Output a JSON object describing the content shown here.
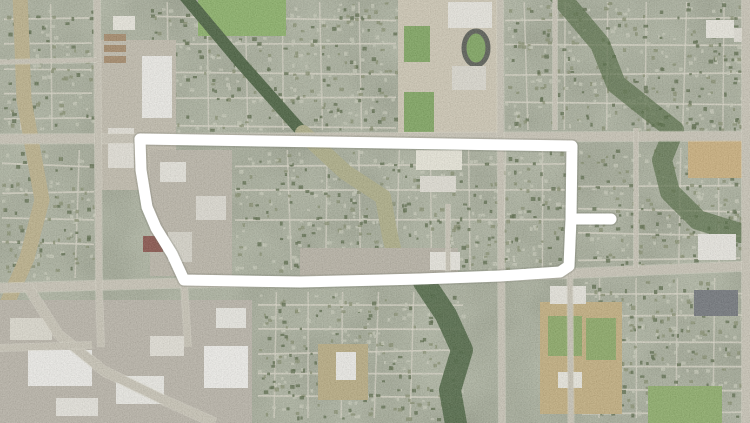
{
  "map": {
    "scene": "aerial-satellite-suburban-grid-with-route-overlay",
    "width": 750,
    "height": 423,
    "seed": 1337,
    "palette": {
      "residential_base": "#96a081",
      "street_minor": "#d7d3c2",
      "road_major": "#c6c1b0",
      "road_edge": "#dcd8c9",
      "roof_light": "#c3c7b1",
      "tree_dark": "#42552e",
      "shrub_olive": "#75805a",
      "route_white": "#ffffff",
      "route_shadow": "#6f7468"
    },
    "route": {
      "color": "#ffffff",
      "stroke_width": 11,
      "loop": [
        [
          572,
          146
        ],
        [
          140,
          139
        ],
        [
          141,
          170
        ],
        [
          147,
          207
        ],
        [
          156,
          228
        ],
        [
          172,
          254
        ],
        [
          184,
          280
        ],
        [
          300,
          282
        ],
        [
          420,
          279
        ],
        [
          500,
          276
        ],
        [
          560,
          272
        ],
        [
          569,
          266
        ],
        [
          571,
          219
        ],
        [
          572,
          146
        ]
      ],
      "spur": [
        [
          572,
          219
        ],
        [
          611,
          219
        ]
      ]
    },
    "roads_major": [
      {
        "name": "arterial-top",
        "width": 9,
        "points": [
          [
            0,
            139
          ],
          [
            750,
            136
          ]
        ]
      },
      {
        "name": "arterial-bottom",
        "width": 9,
        "points": [
          [
            0,
            288
          ],
          [
            184,
            283
          ],
          [
            390,
            280
          ],
          [
            508,
            276
          ],
          [
            750,
            266
          ]
        ]
      },
      {
        "name": "arterial-left-vertical",
        "width": 6,
        "points": [
          [
            97,
            0
          ],
          [
            99,
            290
          ],
          [
            101,
            347
          ]
        ]
      },
      {
        "name": "arterial-center-vertical",
        "width": 6,
        "points": [
          [
            500,
            0
          ],
          [
            502,
            423
          ]
        ]
      },
      {
        "name": "street-route-east-vertical",
        "width": 5,
        "points": [
          [
            569,
            140
          ],
          [
            571,
            423
          ]
        ]
      },
      {
        "name": "arterial-right-vertical",
        "width": 8,
        "points": [
          [
            746,
            0
          ],
          [
            746,
            423
          ]
        ]
      },
      {
        "name": "street-east-mid-vertical",
        "width": 4,
        "points": [
          [
            636,
            128
          ],
          [
            636,
            268
          ]
        ]
      },
      {
        "name": "street-center-mid-vertical",
        "width": 4,
        "points": [
          [
            448,
            204
          ],
          [
            448,
            281
          ]
        ]
      },
      {
        "name": "street-ne-vertical",
        "width": 4,
        "points": [
          [
            555,
            0
          ],
          [
            555,
            130
          ]
        ]
      },
      {
        "name": "arterial-sw-diagonal",
        "width": 9,
        "points": [
          [
            28,
            287
          ],
          [
            58,
            334
          ],
          [
            104,
            371
          ],
          [
            166,
            401
          ],
          [
            215,
            423
          ]
        ]
      },
      {
        "name": "street-sw-horizontal",
        "width": 6,
        "points": [
          [
            0,
            348
          ],
          [
            92,
            345
          ]
        ]
      },
      {
        "name": "street-route-west-diagonal",
        "width": 6,
        "points": [
          [
            140,
            139
          ],
          [
            143,
            192
          ],
          [
            152,
            220
          ],
          [
            171,
            253
          ],
          [
            184,
            283
          ],
          [
            188,
            347
          ]
        ]
      },
      {
        "name": "street-route-spur",
        "width": 4,
        "points": [
          [
            570,
            219
          ],
          [
            616,
            219
          ]
        ]
      },
      {
        "name": "street-nw-horizontal",
        "width": 4,
        "points": [
          [
            0,
            62
          ],
          [
            97,
            60
          ]
        ]
      }
    ],
    "districts": [
      {
        "name": "nw-residential",
        "x": 4,
        "y": 4,
        "w": 88,
        "h": 126,
        "hs": 25,
        "vs": 32
      },
      {
        "name": "north-central-residential",
        "x": 150,
        "y": 2,
        "w": 246,
        "h": 128,
        "hs": 27,
        "vs": 38
      },
      {
        "name": "ne-residential",
        "x": 505,
        "y": 2,
        "w": 238,
        "h": 128,
        "hs": 28,
        "vs": 40
      },
      {
        "name": "east-residential",
        "x": 578,
        "y": 148,
        "w": 162,
        "h": 116,
        "hs": 24,
        "vs": 40
      },
      {
        "name": "inner-loop-residential",
        "x": 235,
        "y": 150,
        "w": 330,
        "h": 120,
        "hs": 26,
        "vs": 36
      },
      {
        "name": "west-mid-residential",
        "x": 2,
        "y": 150,
        "w": 92,
        "h": 128,
        "hs": 26,
        "vs": 30
      },
      {
        "name": "se-residential",
        "x": 582,
        "y": 278,
        "w": 160,
        "h": 140,
        "hs": 24,
        "vs": 38
      },
      {
        "name": "south-central-residential",
        "x": 258,
        "y": 292,
        "w": 205,
        "h": 126,
        "hs": 23,
        "vs": 34
      }
    ],
    "features": [
      {
        "name": "creek-west",
        "kind": "path",
        "stroke": "#b7aa7c",
        "width": 15,
        "points": [
          [
            20,
            -6
          ],
          [
            24,
            100
          ],
          [
            42,
            200
          ],
          [
            27,
            258
          ],
          [
            5,
            308
          ]
        ]
      },
      {
        "name": "park-north",
        "kind": "rect",
        "x": 198,
        "y": 0,
        "w": 88,
        "h": 36,
        "fill": "#7caa52"
      },
      {
        "name": "tree-corridor-nw",
        "kind": "path",
        "stroke": "#2e4a22",
        "width": 12,
        "points": [
          [
            183,
            -6
          ],
          [
            240,
            62
          ],
          [
            303,
            133
          ]
        ]
      },
      {
        "name": "greenway-central",
        "kind": "path",
        "stroke": "#a6a678",
        "width": 16,
        "points": [
          [
            303,
            133
          ],
          [
            345,
            172
          ],
          [
            383,
            197
          ],
          [
            390,
            236
          ],
          [
            399,
            272
          ]
        ]
      },
      {
        "name": "creek-south",
        "kind": "path",
        "stroke": "#2f4d22",
        "width": 22,
        "opacity": 0.9,
        "points": [
          [
            424,
            282
          ],
          [
            446,
            315
          ],
          [
            462,
            350
          ],
          [
            450,
            390
          ],
          [
            456,
            424
          ]
        ]
      },
      {
        "name": "ne-forest-corridor",
        "kind": "path",
        "stroke": "#33511f",
        "width": 20,
        "opacity": 0.7,
        "points": [
          [
            558,
            -6
          ],
          [
            578,
            18
          ],
          [
            600,
            44
          ],
          [
            616,
            84
          ],
          [
            646,
            108
          ],
          [
            674,
            130
          ],
          [
            662,
            160
          ],
          [
            670,
            192
          ],
          [
            698,
            220
          ],
          [
            740,
            233
          ]
        ]
      },
      {
        "name": "school-campus",
        "kind": "rect",
        "x": 398,
        "y": 0,
        "w": 102,
        "h": 138,
        "fill": "#cdc5ae"
      },
      {
        "name": "school-field-a",
        "kind": "rect",
        "x": 404,
        "y": 92,
        "w": 30,
        "h": 40,
        "fill": "#6e9c49"
      },
      {
        "name": "school-field-b",
        "kind": "rect",
        "x": 404,
        "y": 26,
        "w": 26,
        "h": 36,
        "fill": "#6e9c49"
      },
      {
        "name": "track-oval",
        "kind": "ellipse",
        "cx": 476,
        "cy": 48,
        "rx": 12,
        "ry": 17,
        "fill": "#6e9c49",
        "stroke": "#41453c",
        "sw": 5
      },
      {
        "name": "school-building-a",
        "kind": "rect",
        "x": 448,
        "y": 2,
        "w": 44,
        "h": 26,
        "fill": "#ebe9e0"
      },
      {
        "name": "school-building-b",
        "kind": "rect",
        "x": 452,
        "y": 66,
        "w": 34,
        "h": 24,
        "fill": "#dcd9cd"
      },
      {
        "name": "west-retail-lot",
        "kind": "rect",
        "x": 98,
        "y": 40,
        "w": 78,
        "h": 150,
        "fill": "#bdb7a5"
      },
      {
        "name": "west-retail-building-a",
        "kind": "rect",
        "x": 142,
        "y": 56,
        "w": 30,
        "h": 62,
        "fill": "#f1f0ea"
      },
      {
        "name": "west-retail-building-b",
        "kind": "rect",
        "x": 108,
        "y": 128,
        "w": 26,
        "h": 40,
        "fill": "#e5e2d7"
      },
      {
        "name": "storage-row-a",
        "kind": "rect",
        "x": 104,
        "y": 34,
        "w": 22,
        "h": 7,
        "fill": "#9b7b55"
      },
      {
        "name": "storage-row-b",
        "kind": "rect",
        "x": 104,
        "y": 45,
        "w": 22,
        "h": 7,
        "fill": "#9b7b55"
      },
      {
        "name": "storage-row-c",
        "kind": "rect",
        "x": 104,
        "y": 56,
        "w": 22,
        "h": 7,
        "fill": "#9b7b55"
      },
      {
        "name": "nw-building",
        "kind": "rect",
        "x": 113,
        "y": 16,
        "w": 22,
        "h": 14,
        "fill": "#eceade"
      },
      {
        "name": "office-zone-west",
        "kind": "rect",
        "x": 150,
        "y": 150,
        "w": 82,
        "h": 126,
        "fill": "#b6b0a0"
      },
      {
        "name": "office-building-a",
        "kind": "rect",
        "x": 160,
        "y": 162,
        "w": 26,
        "h": 20,
        "fill": "#e8e6dc"
      },
      {
        "name": "office-building-b",
        "kind": "rect",
        "x": 196,
        "y": 196,
        "w": 30,
        "h": 24,
        "fill": "#dedbd0"
      },
      {
        "name": "office-building-c",
        "kind": "rect",
        "x": 168,
        "y": 232,
        "w": 24,
        "h": 30,
        "fill": "#d6d3c6"
      },
      {
        "name": "brick-building",
        "kind": "rect",
        "x": 143,
        "y": 236,
        "w": 20,
        "h": 16,
        "fill": "#7a3a30"
      },
      {
        "name": "retail-central-a",
        "kind": "rect",
        "x": 416,
        "y": 150,
        "w": 46,
        "h": 20,
        "fill": "#eceada"
      },
      {
        "name": "retail-central-b",
        "kind": "rect",
        "x": 420,
        "y": 176,
        "w": 36,
        "h": 16,
        "fill": "#e2dfd3"
      },
      {
        "name": "commercial-inner-south",
        "kind": "rect",
        "x": 300,
        "y": 248,
        "w": 158,
        "h": 28,
        "fill": "#b2ac9c"
      },
      {
        "name": "commercial-inner-south-building",
        "kind": "rect",
        "x": 430,
        "y": 252,
        "w": 30,
        "h": 18,
        "fill": "#eae8de"
      },
      {
        "name": "sw-commercial-zone",
        "kind": "rect",
        "x": 0,
        "y": 300,
        "w": 252,
        "h": 123,
        "fill": "#b4aea0"
      },
      {
        "name": "sw-building-a",
        "kind": "rect",
        "x": 28,
        "y": 350,
        "w": 64,
        "h": 36,
        "fill": "#f2f1ec"
      },
      {
        "name": "sw-building-b",
        "kind": "rect",
        "x": 116,
        "y": 376,
        "w": 48,
        "h": 28,
        "fill": "#eeede6"
      },
      {
        "name": "sw-building-c",
        "kind": "rect",
        "x": 204,
        "y": 346,
        "w": 44,
        "h": 42,
        "fill": "#f4f3ee"
      },
      {
        "name": "sw-building-d",
        "kind": "rect",
        "x": 56,
        "y": 398,
        "w": 42,
        "h": 18,
        "fill": "#e8e6dd"
      },
      {
        "name": "sw-building-e",
        "kind": "rect",
        "x": 10,
        "y": 318,
        "w": 42,
        "h": 22,
        "fill": "#dddacc"
      },
      {
        "name": "sw-building-f",
        "kind": "rect",
        "x": 150,
        "y": 336,
        "w": 34,
        "h": 20,
        "fill": "#e4e1d6"
      },
      {
        "name": "sw-building-g",
        "kind": "rect",
        "x": 216,
        "y": 308,
        "w": 30,
        "h": 20,
        "fill": "#ecebe3"
      },
      {
        "name": "church-field",
        "kind": "rect",
        "x": 318,
        "y": 344,
        "w": 50,
        "h": 56,
        "fill": "#b3a472"
      },
      {
        "name": "church-building",
        "kind": "rect",
        "x": 336,
        "y": 352,
        "w": 20,
        "h": 28,
        "fill": "#f0efe9"
      },
      {
        "name": "ballpark-field",
        "kind": "rect",
        "x": 540,
        "y": 302,
        "w": 82,
        "h": 112,
        "fill": "#bfa76e"
      },
      {
        "name": "ballpark-green-a",
        "kind": "rect",
        "x": 548,
        "y": 316,
        "w": 34,
        "h": 40,
        "fill": "#7da050"
      },
      {
        "name": "ballpark-green-b",
        "kind": "rect",
        "x": 586,
        "y": 318,
        "w": 30,
        "h": 42,
        "fill": "#7da050"
      },
      {
        "name": "ballpark-building",
        "kind": "rect",
        "x": 558,
        "y": 372,
        "w": 24,
        "h": 16,
        "fill": "#eceadf"
      },
      {
        "name": "commercial-bottom-road-building",
        "kind": "rect",
        "x": 550,
        "y": 286,
        "w": 36,
        "h": 18,
        "fill": "#e9e7dd"
      },
      {
        "name": "east-apartments",
        "kind": "rect",
        "x": 688,
        "y": 136,
        "w": 58,
        "h": 42,
        "fill": "#c9a86b"
      },
      {
        "name": "east-commercial-white",
        "kind": "rect",
        "x": 698,
        "y": 234,
        "w": 38,
        "h": 26,
        "fill": "#eceae2"
      },
      {
        "name": "east-commercial-dark",
        "kind": "rect",
        "x": 694,
        "y": 290,
        "w": 44,
        "h": 26,
        "fill": "#5f646a"
      },
      {
        "name": "golf-green-se",
        "kind": "rect",
        "x": 648,
        "y": 386,
        "w": 74,
        "h": 37,
        "fill": "#7fa554"
      },
      {
        "name": "ne-building-a",
        "kind": "rect",
        "x": 706,
        "y": 20,
        "w": 28,
        "h": 18,
        "fill": "#eceadf"
      },
      {
        "name": "ne-building-b",
        "kind": "rect",
        "x": 734,
        "y": 28,
        "w": 16,
        "h": 14,
        "fill": "#e2dfd4"
      }
    ]
  }
}
